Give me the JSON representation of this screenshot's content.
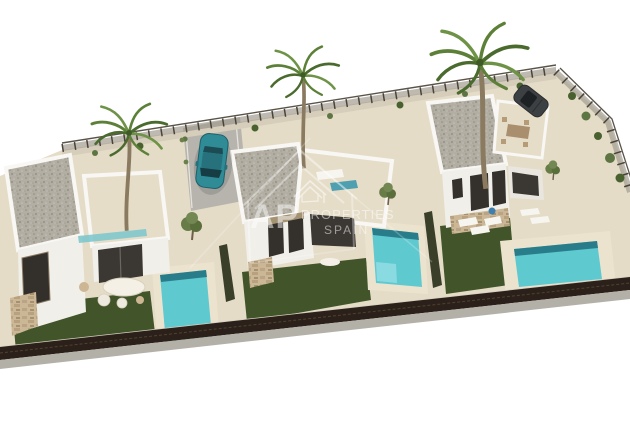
{
  "watermark": {
    "brand_initials": "AP",
    "brand_name": "PROPERTIES",
    "brand_region": "SPAIN"
  },
  "scene": {
    "villas_count": "3",
    "pools_count": "3",
    "palm_trees_count": "3"
  },
  "colors": {
    "background": "#ffffff",
    "sand": "#e5dcc8",
    "deck": "#ece3cf",
    "wall_white": "#f1efe9",
    "gravel_roof": "#b2aea3",
    "lawn_green": "#42552a",
    "pool_water": "#5fc9d0",
    "pool_water_deep": "#20707f",
    "boundary_wall": "#2b211a",
    "driveway_gray": "#b7b4ae",
    "car_teal": "#2f8b96",
    "car_dark": "#3d4042",
    "palm_green": "#5d8038",
    "watermark_white": "#ffffff"
  }
}
